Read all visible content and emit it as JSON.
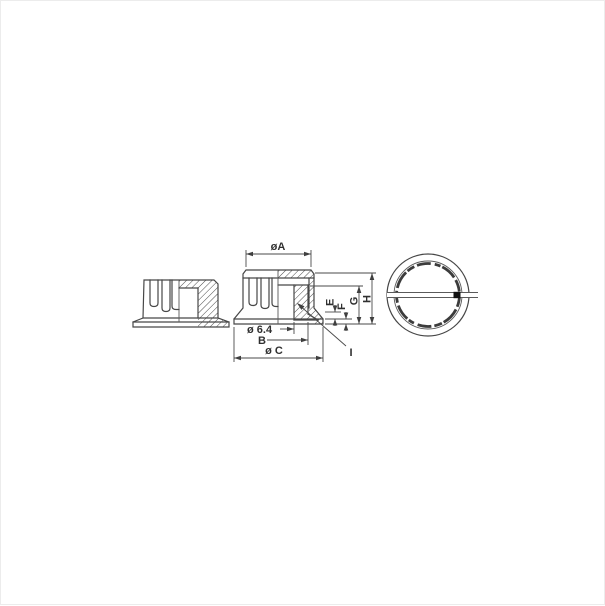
{
  "title": "Skirted control knob — dimensioned technical drawing, three views",
  "drawing": {
    "views": {
      "side_section": "half-section side elevation",
      "front_section": "dimensioned half-section front view",
      "top": "top view with indicator slot and index mark"
    },
    "dimensions": {
      "top_diameter": "øA",
      "bore_diameter": "ø 6.4",
      "hub_diameter": "B",
      "skirt_diameter": "ø C",
      "dim_e": "E",
      "dim_f": "F",
      "dim_g": "G",
      "dim_h": "H",
      "detail_i": "I"
    },
    "colors": {
      "line": "#474747",
      "background": "#ffffff",
      "index_mark": "#111111"
    }
  }
}
